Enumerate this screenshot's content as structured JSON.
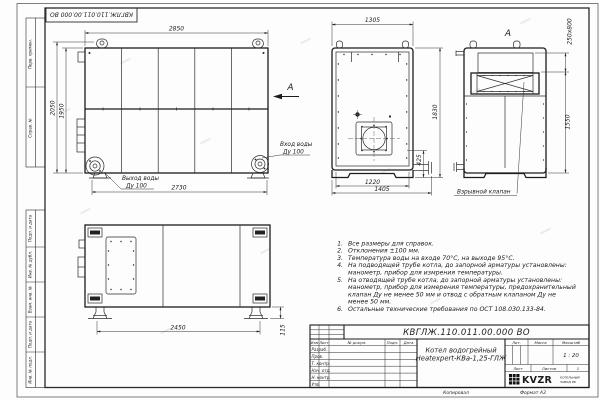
{
  "sheet": {
    "top_stamp": "КВГЛЖ.110.011.00.000 ВО",
    "footer": {
      "copied": "Копировал",
      "format": "Формат А3"
    },
    "margin_labels": {
      "top": [
        "Перв. примен.",
        "Справ. №"
      ],
      "bottom": [
        "Подп. и дата",
        "Инв. № дубл.",
        "Взам. инв. №",
        "Подп. и дата",
        "Инв. № подл."
      ]
    }
  },
  "views": {
    "side": {
      "dim_top": "2850",
      "dim_bottom": "2730",
      "dim_left_outer": "2050",
      "dim_left_inner": "1950",
      "outlet_label": "Выход воды",
      "outlet_dn": "Ду 100",
      "inlet_label": "Вход воды",
      "inlet_dn": "Ду 100",
      "section_mark": "А"
    },
    "front": {
      "dim_top": "1305",
      "dim_right": "1830",
      "dim_right_small": "425",
      "dim_bottom_inner": "1220",
      "dim_bottom_outer": "1405"
    },
    "view_a": {
      "label": "А",
      "dim_valve": "250x800",
      "dim_height": "1550",
      "callout": "Взрывной клапан"
    },
    "top": {
      "dim_width": "2450",
      "dim_foot": "115"
    }
  },
  "notes": {
    "lines": [
      {
        "num": "1.",
        "text": "Все размеры для справок."
      },
      {
        "num": "2.",
        "text": "Отклонения ±100 мм."
      },
      {
        "num": "3.",
        "text": "Температура воды на входе 70°С, на выходе 95°С."
      },
      {
        "num": "4.",
        "text": "На подводящей трубе котла, до запорной арматуры установлены:"
      },
      {
        "num": "",
        "text": "манометр, прибор для измрения температуры."
      },
      {
        "num": "5.",
        "text": "На отводящей трубе котла, до запорной арматуры установлены:"
      },
      {
        "num": "",
        "text": "манометр, прибор для измерения температуры, предохранительный"
      },
      {
        "num": "",
        "text": "клапан Ду не менее 50 мм и отвод с обратным клапаном Ду не"
      },
      {
        "num": "",
        "text": "менее 50 мм."
      },
      {
        "num": "6.",
        "text": "Остальные технические требования по ОСТ 108.030.133-84."
      }
    ]
  },
  "title_block": {
    "doc_number": "КВГЛЖ.110.011.00.000 ВО",
    "product_name_1": "Котел водогрейный",
    "product_name_2": "Heatexpert-КВа-1,25-ГЛЖ",
    "cols": {
      "izm": "Изм",
      "list": "Лист",
      "doc": "№ докум.",
      "podp": "Подп.",
      "data": "Дата"
    },
    "rows": [
      "Разраб.",
      "Пров.",
      "Т. контр.",
      "Нач. отд.",
      "Н. контр.",
      "Утв."
    ],
    "lit": "Лит.",
    "mass": "Масса",
    "scale_label": "Масштаб",
    "scale": "1 : 20",
    "sheet_label": "Лист",
    "sheets_label": "Листов",
    "sheets_value": "1",
    "logo": "KVZR",
    "logo_caption_1": "КОТЕЛЬНЫЙ",
    "logo_caption_2": "ЗАВОД РФ"
  }
}
